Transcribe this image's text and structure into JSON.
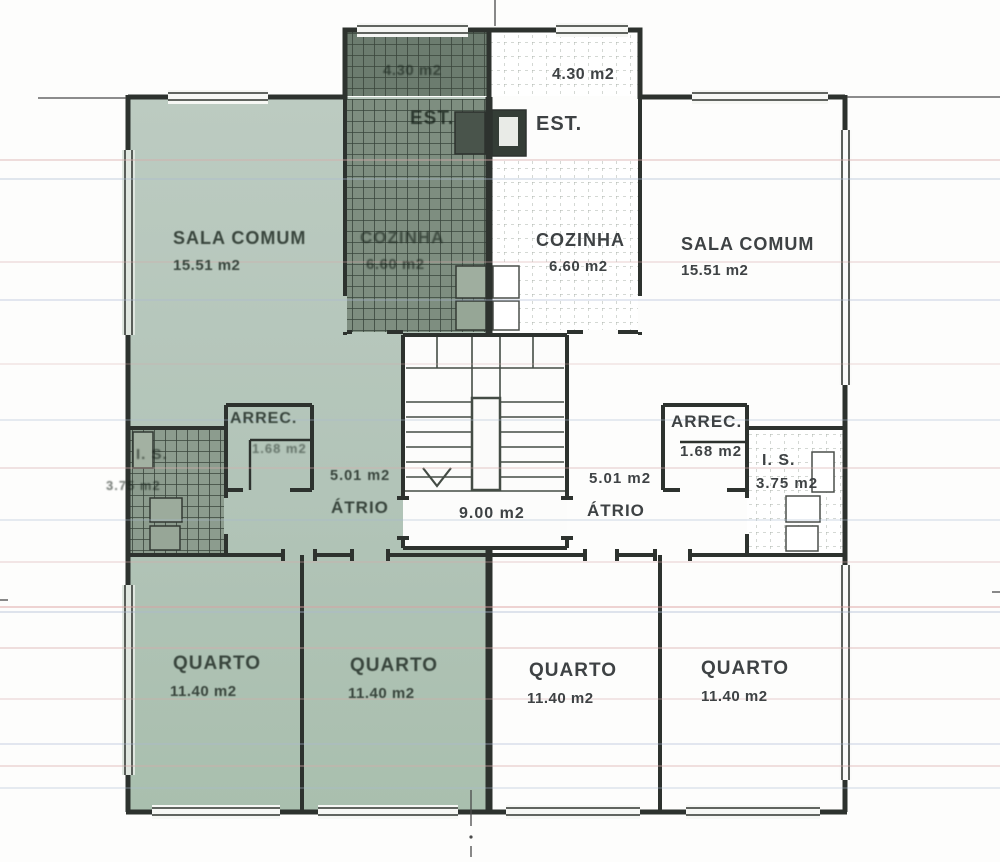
{
  "colors": {
    "highlight_tint": "#b2c4b8",
    "dark_tile": "#6c7c6f",
    "wall": "#2d322e"
  },
  "stairwell": {
    "area": "9.00 m2"
  },
  "apartment_left": {
    "est": {
      "label": "EST.",
      "area": "4.30 m2"
    },
    "sala_comum": {
      "label": "SALA COMUM",
      "area": "15.51 m2"
    },
    "cozinha": {
      "label": "COZINHA",
      "area": "6.60 m2"
    },
    "arrec": {
      "label": "ARREC.",
      "area": "1.68 m2"
    },
    "is": {
      "label": "I. S.",
      "area": "3.75 m2"
    },
    "atrio": {
      "label": "ÁTRIO",
      "area": "5.01 m2"
    },
    "quarto_1": {
      "label": "QUARTO",
      "area": "11.40 m2"
    },
    "quarto_2": {
      "label": "QUARTO",
      "area": "11.40 m2"
    }
  },
  "apartment_right": {
    "est": {
      "label": "EST.",
      "area": "4.30 m2"
    },
    "sala_comum": {
      "label": "SALA COMUM",
      "area": "15.51 m2"
    },
    "cozinha": {
      "label": "COZINHA",
      "area": "6.60 m2"
    },
    "arrec": {
      "label": "ARREC.",
      "area": "1.68 m2"
    },
    "is": {
      "label": "I. S.",
      "area": "3.75 m2"
    },
    "atrio": {
      "label": "ÁTRIO",
      "area": "5.01 m2"
    },
    "quarto_1": {
      "label": "QUARTO",
      "area": "11.40 m2"
    },
    "quarto_2": {
      "label": "QUARTO",
      "area": "11.40 m2"
    }
  }
}
